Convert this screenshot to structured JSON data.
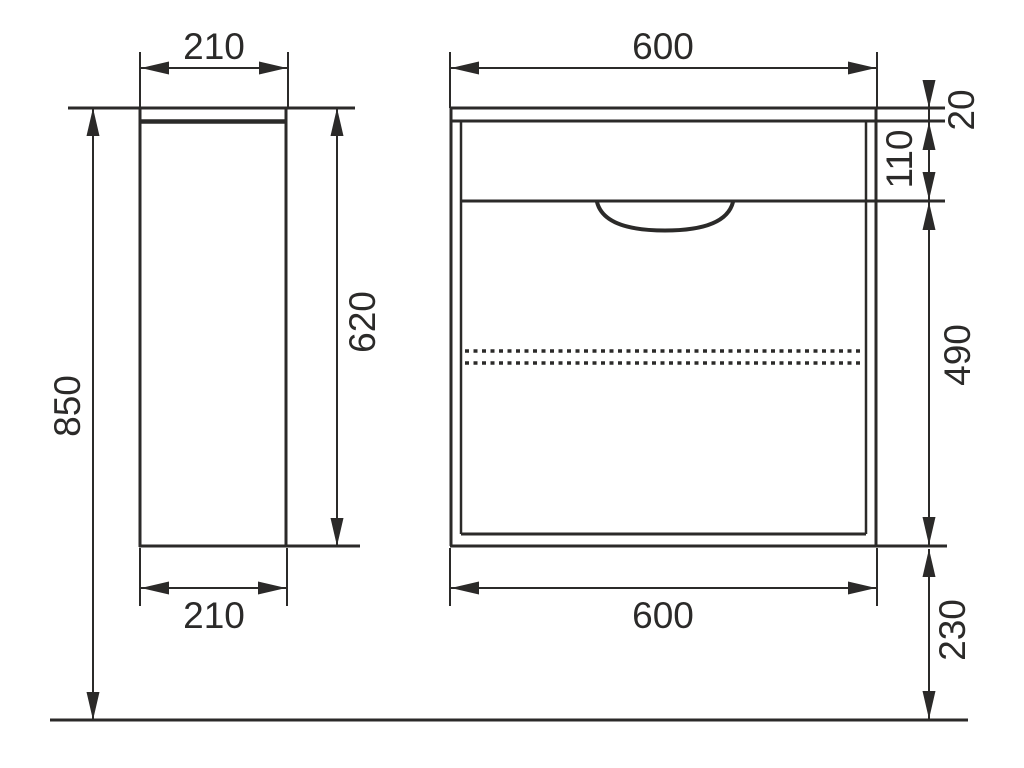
{
  "drawing": {
    "type": "technical-dimension-drawing",
    "subject": "wall-hung vanity cabinet, side view and front view",
    "background_color": "#ffffff",
    "line_color": "#2b2a29",
    "views": {
      "side": {
        "label": "side-view",
        "dims": {
          "width_top": "210",
          "width_bottom": "210",
          "cabinet_height": "620",
          "total_height": "850"
        }
      },
      "front": {
        "label": "front-view",
        "dims": {
          "width_top": "600",
          "width_bottom": "600",
          "top_panel_thickness": "20",
          "drawer_front_height": "110",
          "lower_section_height": "490",
          "floor_clearance": "230"
        }
      }
    }
  }
}
